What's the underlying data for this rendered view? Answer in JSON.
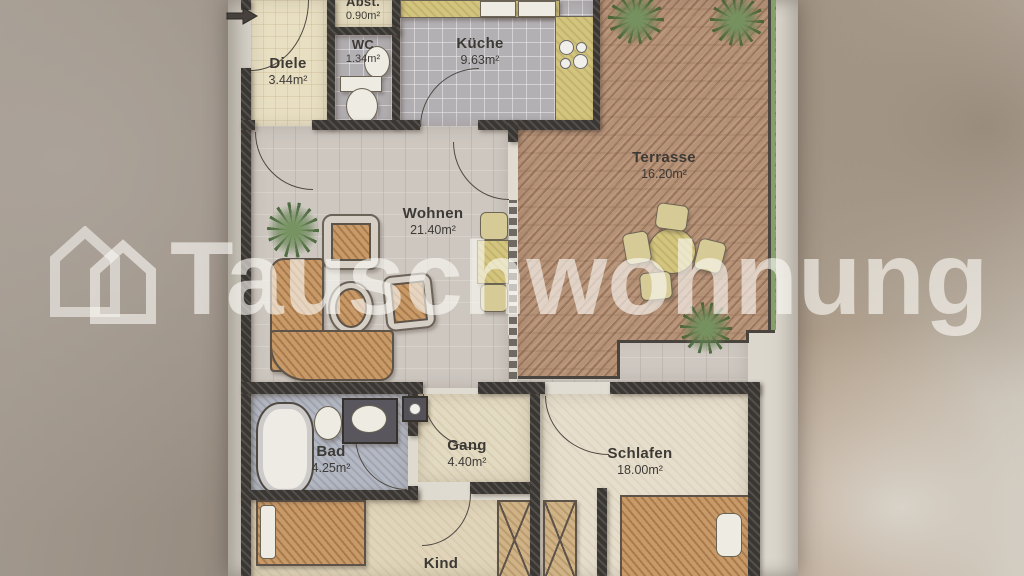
{
  "watermark": {
    "brand": "Tauschwohnung"
  },
  "floor_plan": {
    "rooms": [
      {
        "name": "Diele",
        "area": "3.44m²"
      },
      {
        "name": "Abst.",
        "area": "0.90m²"
      },
      {
        "name": "WC",
        "area": "1.34m²"
      },
      {
        "name": "Küche",
        "area": "9.63m²"
      },
      {
        "name": "Terrasse",
        "area": "16.20m²"
      },
      {
        "name": "Wohnen",
        "area": "21.40m²"
      },
      {
        "name": "Bad",
        "area": "4.25m²"
      },
      {
        "name": "Gang",
        "area": "4.40m²"
      },
      {
        "name": "Schlafen",
        "area": "18.00m²"
      },
      {
        "name": "Kind"
      }
    ]
  },
  "colors": {
    "wall": "#3a3632",
    "terrace-floor": "#b59176",
    "living-floor": "#cdc7c0",
    "tile-floor": "#b3b0b4",
    "bath-floor": "#b4b8c2",
    "hall-floor": "#e3dac2",
    "bedroom-floor": "#e6decc",
    "wood-furniture": "#c79a68",
    "kitchen-counter": "#d3c57e",
    "boundary-green": "#86a06c",
    "watermark-white": "rgba(252,250,245,0.62)"
  }
}
